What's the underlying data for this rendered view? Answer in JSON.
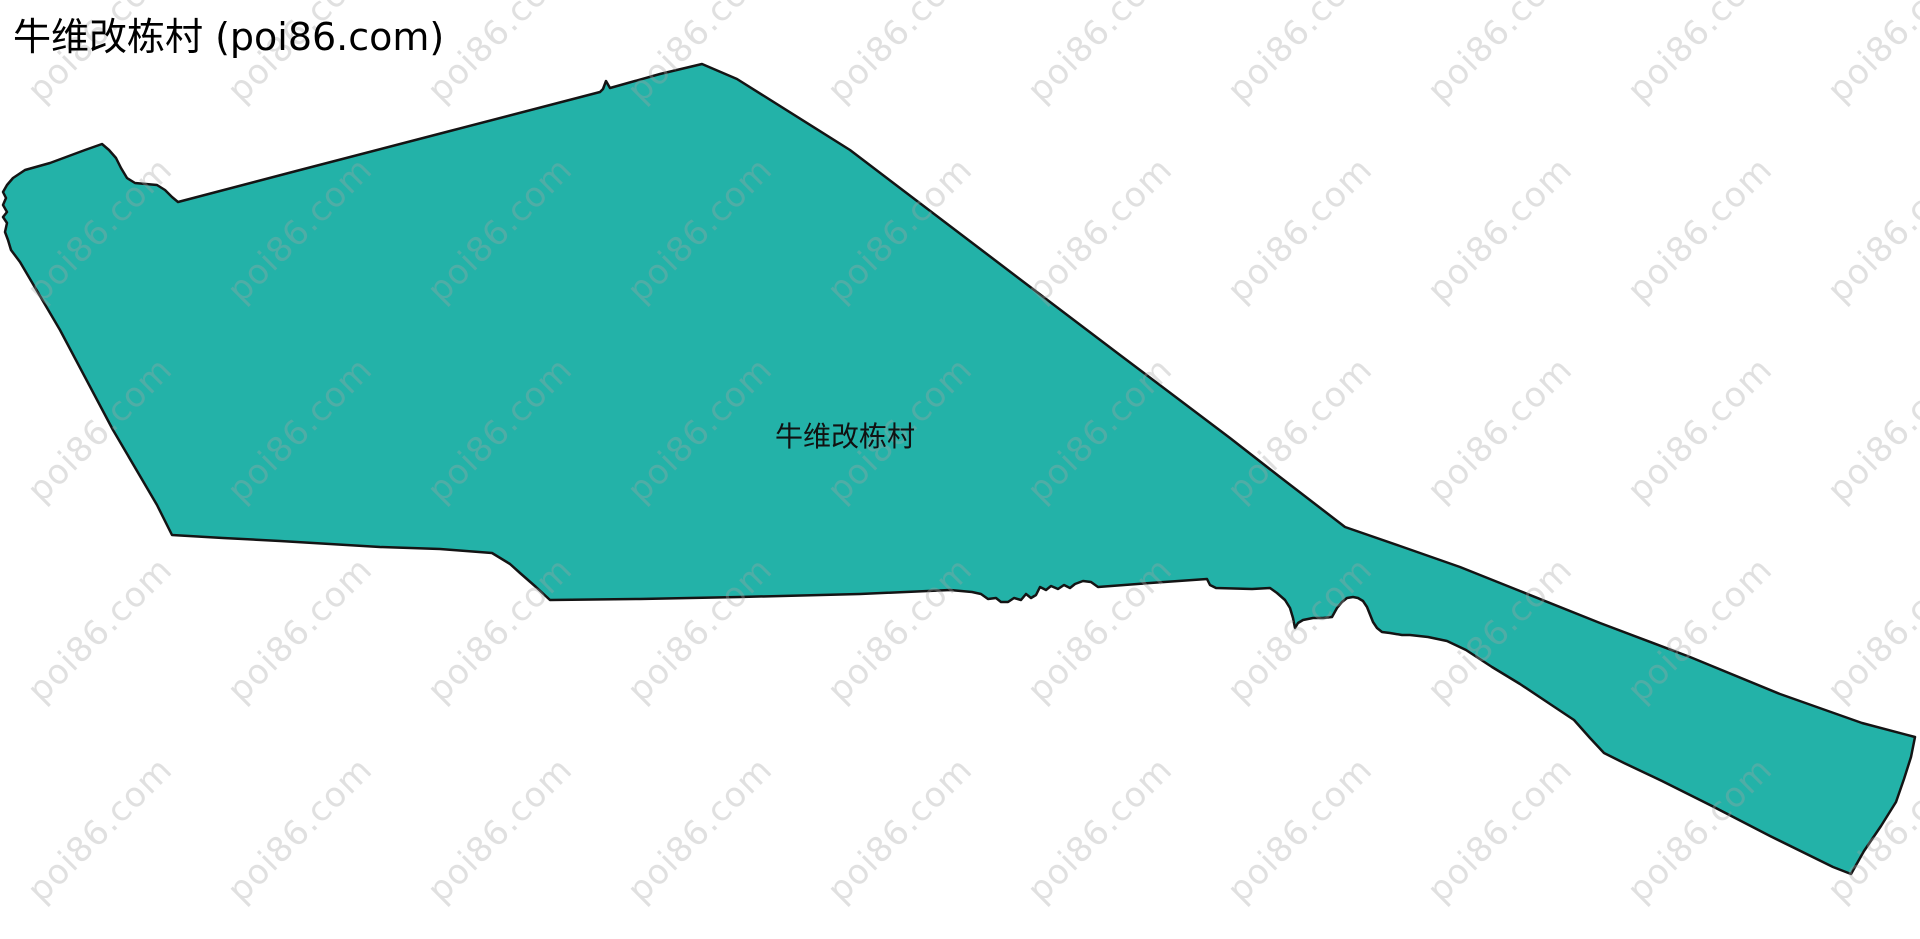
{
  "page": {
    "title": "牛维改栋村 (poi86.com)",
    "background_color": "#ffffff"
  },
  "map": {
    "label": "牛维改栋村",
    "label_position": {
      "x": 845,
      "y": 435
    },
    "region": {
      "name": "牛维改栋村",
      "fill_color": "#23b2a8",
      "stroke_color": "#141414",
      "stroke_width": 2.5,
      "points": [
        [
          702,
          64
        ],
        [
          737,
          79
        ],
        [
          850,
          150
        ],
        [
          1000,
          264
        ],
        [
          1120,
          355
        ],
        [
          1230,
          438
        ],
        [
          1280,
          477
        ],
        [
          1345,
          527
        ],
        [
          1400,
          546
        ],
        [
          1460,
          567
        ],
        [
          1520,
          591
        ],
        [
          1600,
          623
        ],
        [
          1690,
          657
        ],
        [
          1780,
          694
        ],
        [
          1862,
          723
        ],
        [
          1915,
          737
        ],
        [
          1911,
          757
        ],
        [
          1904,
          779
        ],
        [
          1896,
          802
        ],
        [
          1881,
          826
        ],
        [
          1864,
          851
        ],
        [
          1851,
          874
        ],
        [
          1833,
          867
        ],
        [
          1770,
          836
        ],
        [
          1712,
          806
        ],
        [
          1662,
          781
        ],
        [
          1624,
          763
        ],
        [
          1604,
          753
        ],
        [
          1590,
          738
        ],
        [
          1574,
          720
        ],
        [
          1550,
          704
        ],
        [
          1520,
          684
        ],
        [
          1492,
          667
        ],
        [
          1466,
          650
        ],
        [
          1447,
          641
        ],
        [
          1428,
          637
        ],
        [
          1410,
          635
        ],
        [
          1402,
          635
        ],
        [
          1390,
          633
        ],
        [
          1382,
          632
        ],
        [
          1377,
          628
        ],
        [
          1373,
          622
        ],
        [
          1367,
          607
        ],
        [
          1363,
          601
        ],
        [
          1358,
          598
        ],
        [
          1353,
          597
        ],
        [
          1347,
          598
        ],
        [
          1342,
          602
        ],
        [
          1337,
          608
        ],
        [
          1332,
          617
        ],
        [
          1323,
          618
        ],
        [
          1313,
          618
        ],
        [
          1303,
          620
        ],
        [
          1298,
          623
        ],
        [
          1295,
          628
        ],
        [
          1293,
          618
        ],
        [
          1290,
          608
        ],
        [
          1285,
          600
        ],
        [
          1277,
          593
        ],
        [
          1270,
          588
        ],
        [
          1252,
          589
        ],
        [
          1216,
          588
        ],
        [
          1210,
          585
        ],
        [
          1207,
          579
        ],
        [
          1150,
          583
        ],
        [
          1098,
          587
        ],
        [
          1091,
          582
        ],
        [
          1083,
          581
        ],
        [
          1075,
          584
        ],
        [
          1070,
          588
        ],
        [
          1064,
          585
        ],
        [
          1058,
          589
        ],
        [
          1051,
          586
        ],
        [
          1046,
          590
        ],
        [
          1040,
          587
        ],
        [
          1036,
          595
        ],
        [
          1031,
          598
        ],
        [
          1026,
          594
        ],
        [
          1021,
          600
        ],
        [
          1014,
          598
        ],
        [
          1008,
          602
        ],
        [
          1001,
          602
        ],
        [
          996,
          598
        ],
        [
          988,
          599
        ],
        [
          981,
          594
        ],
        [
          972,
          592
        ],
        [
          950,
          590
        ],
        [
          860,
          594
        ],
        [
          740,
          597
        ],
        [
          640,
          599
        ],
        [
          550,
          600
        ],
        [
          536,
          587
        ],
        [
          520,
          573
        ],
        [
          510,
          564
        ],
        [
          492,
          553
        ],
        [
          440,
          549
        ],
        [
          380,
          547
        ],
        [
          280,
          541
        ],
        [
          223,
          538
        ],
        [
          172,
          535
        ],
        [
          157,
          505
        ],
        [
          113,
          430
        ],
        [
          60,
          330
        ],
        [
          20,
          262
        ],
        [
          11,
          250
        ],
        [
          8,
          240
        ],
        [
          5,
          232
        ],
        [
          7,
          223
        ],
        [
          3,
          217
        ],
        [
          7,
          212
        ],
        [
          3,
          205
        ],
        [
          6,
          198
        ],
        [
          3,
          192
        ],
        [
          7,
          185
        ],
        [
          13,
          178
        ],
        [
          25,
          170
        ],
        [
          50,
          163
        ],
        [
          85,
          150
        ],
        [
          102,
          144
        ],
        [
          109,
          150
        ],
        [
          116,
          158
        ],
        [
          121,
          168
        ],
        [
          127,
          178
        ],
        [
          135,
          183
        ],
        [
          146,
          184
        ],
        [
          157,
          185
        ],
        [
          165,
          190
        ],
        [
          172,
          197
        ],
        [
          178,
          202
        ],
        [
          300,
          170
        ],
        [
          450,
          131
        ],
        [
          600,
          92
        ],
        [
          603,
          89
        ],
        [
          606,
          81
        ],
        [
          610,
          88
        ],
        [
          660,
          74
        ]
      ]
    }
  },
  "watermark": {
    "text": "poi86.com",
    "color": "rgba(165,165,165,0.34)",
    "font_size": 34,
    "rotation_deg": -45,
    "grid": {
      "start_x": 100,
      "start_y": 30,
      "spacing_x": 200,
      "spacing_y": 200,
      "cols": 10,
      "rows": 5
    }
  }
}
